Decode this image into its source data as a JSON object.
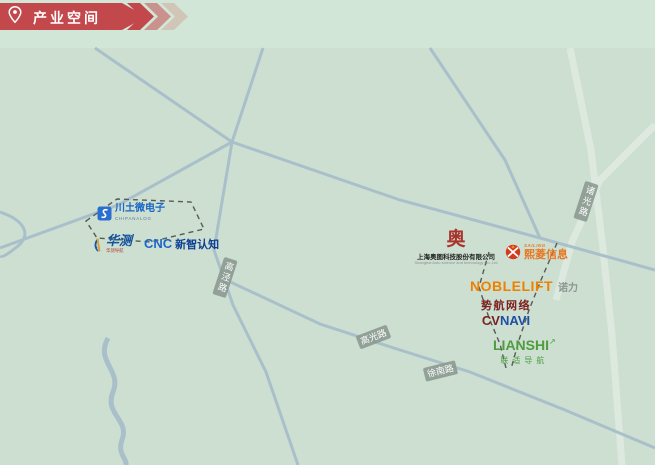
{
  "header": {
    "title": "产业空间",
    "banner_color": "#c2484c",
    "chevron_colors": [
      "#c2484c",
      "#c9928d",
      "#d1c5b7"
    ]
  },
  "map": {
    "background_top": "#d2e6d7",
    "background_map": "#ccdfd1",
    "road_color": "#a9c0ca",
    "road_labels": {
      "gaojing": {
        "text": "高泾路"
      },
      "gaoguang": {
        "text": "高光路"
      },
      "xunan": {
        "text": "徐南路"
      },
      "zhuguang": {
        "text": "诸光路"
      }
    },
    "companies": {
      "chipanalog": {
        "name": "川土微电子",
        "brand": "CHIPANALOG"
      },
      "huace": {
        "name": "华测",
        "sub": "华测导航"
      },
      "cnc": {
        "logo": "CNC",
        "name": "新智认知"
      },
      "aotu": {
        "glyph": "奥",
        "name": "上海奥图科技股份有限公司",
        "sub": "Shanghai Aotu science and technology Co.,Ltd"
      },
      "sailing": {
        "brand": "SAILING",
        "name": "熙菱信息"
      },
      "noblelift": {
        "logo": "NOBLELIFT",
        "name": "诺力"
      },
      "cvnavi": {
        "name": "势航网络",
        "logo_c": "CV",
        "logo_n": "NAVI"
      },
      "lianshi": {
        "logo": "LIANSHI",
        "arrow": "↗",
        "name": "联适导航"
      }
    }
  }
}
